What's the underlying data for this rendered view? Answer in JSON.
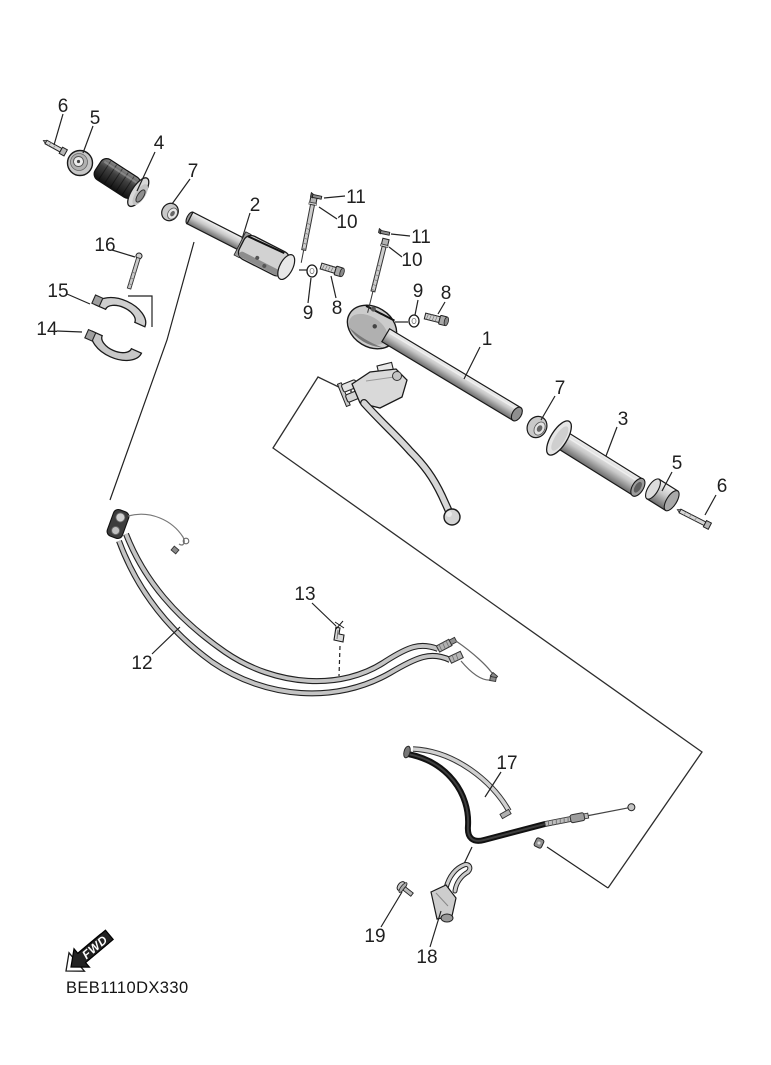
{
  "diagram": {
    "part_code": "BEB1110DX330",
    "fwd_label": "FWD",
    "callouts": [
      "6",
      "5",
      "4",
      "7",
      "2",
      "11",
      "10",
      "11",
      "10",
      "9",
      "8",
      "9",
      "8",
      "1",
      "7",
      "3",
      "5",
      "6",
      "16",
      "15",
      "14",
      "12",
      "13",
      "17",
      "19",
      "18"
    ],
    "colors": {
      "background": "#ffffff",
      "ink": "#1f1f1f",
      "metal_light": "#d9d9d9",
      "metal_dark": "#6b6b6b",
      "grip_dark": "#2f2f2f"
    }
  }
}
